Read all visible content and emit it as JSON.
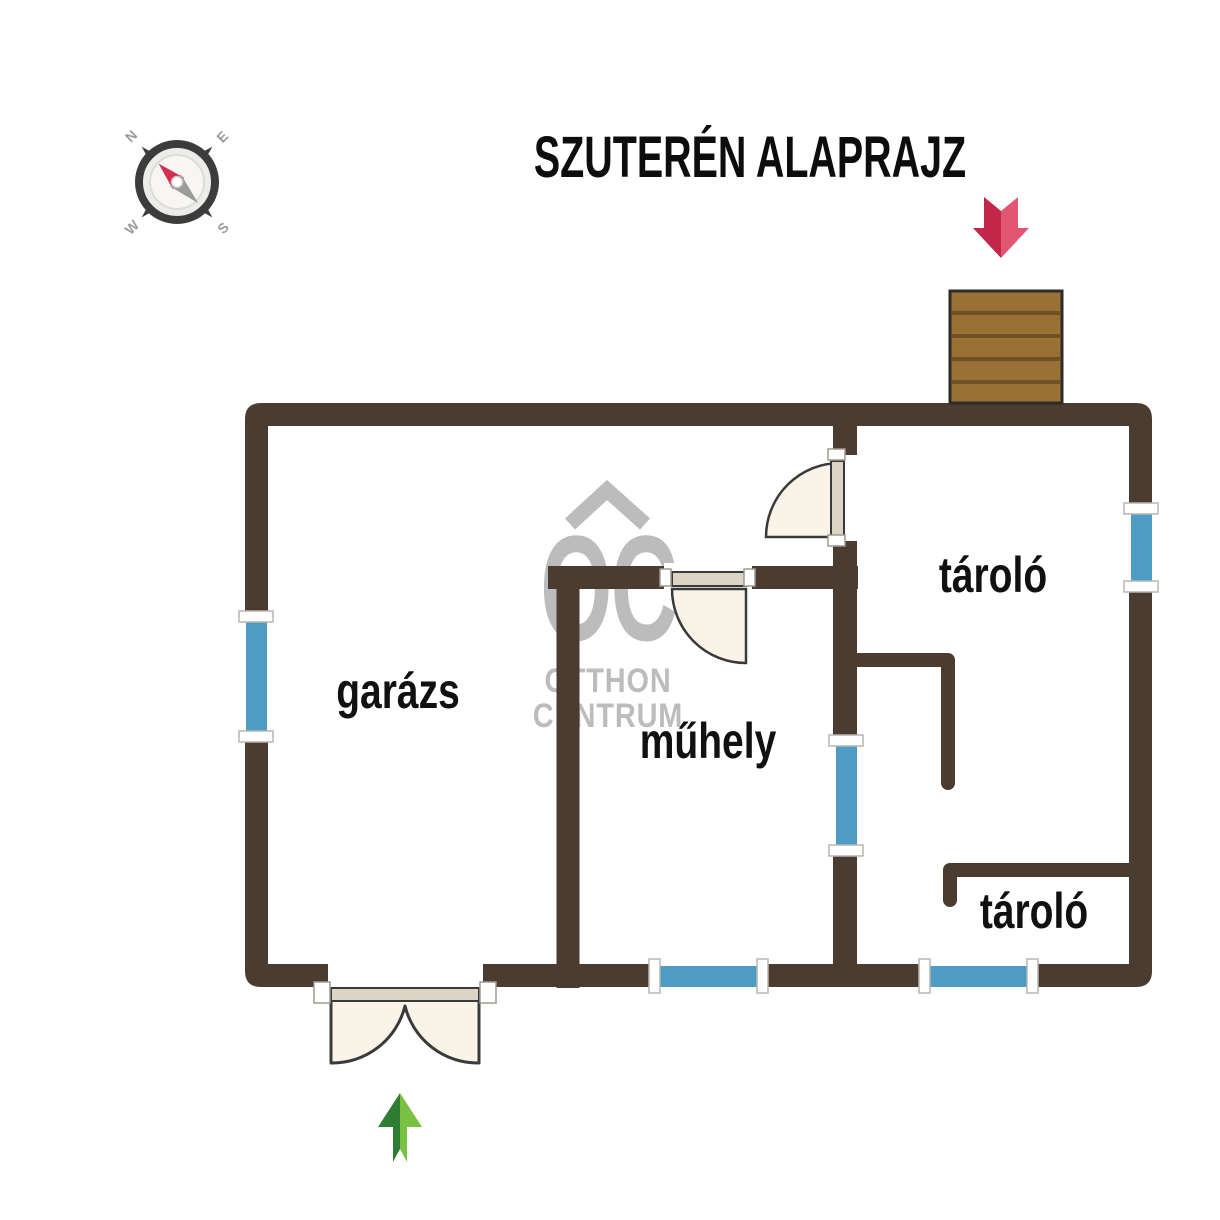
{
  "title": "SZUTERÉN ALAPRAJZ",
  "compass": {
    "icon": "compass-rose-icon",
    "n": "N",
    "e": "E",
    "s": "S",
    "w": "W"
  },
  "watermark": {
    "monogram": "OC",
    "line1": "OTTHON",
    "line2": "CENTRUM",
    "roof_icon": "roof-chevron-icon"
  },
  "rooms": {
    "garage": {
      "label": "garázs"
    },
    "workshop": {
      "label": "műhely"
    },
    "storage_top": {
      "label": "tároló"
    },
    "storage_bottom": {
      "label": "tároló"
    }
  },
  "icons": {
    "entrance_arrow": "red-arrow-down-icon",
    "exit_arrow": "green-arrow-up-icon",
    "stairs": "stairs-icon",
    "windows": "window-symbol",
    "doors": "door-swing-symbol"
  },
  "colors": {
    "wall": "#4A3C31",
    "window_glass": "#4E9CC6",
    "window_sill": "#FFFFFF",
    "door_leaf": "#DCD4C5",
    "door_swing": "#FAF3E8",
    "stairs_wood": "#9A7134",
    "stairs_gap": "#6E5126",
    "entrance_arrow_dark": "#C2274A",
    "entrance_arrow_light": "#E25672",
    "exit_arrow_dark": "#2E7D33",
    "exit_arrow_light": "#79C143",
    "watermark_gray": "#B9B9B9",
    "compass_needle_north": "#D2304E",
    "compass_needle_south": "#9C9C9C"
  }
}
